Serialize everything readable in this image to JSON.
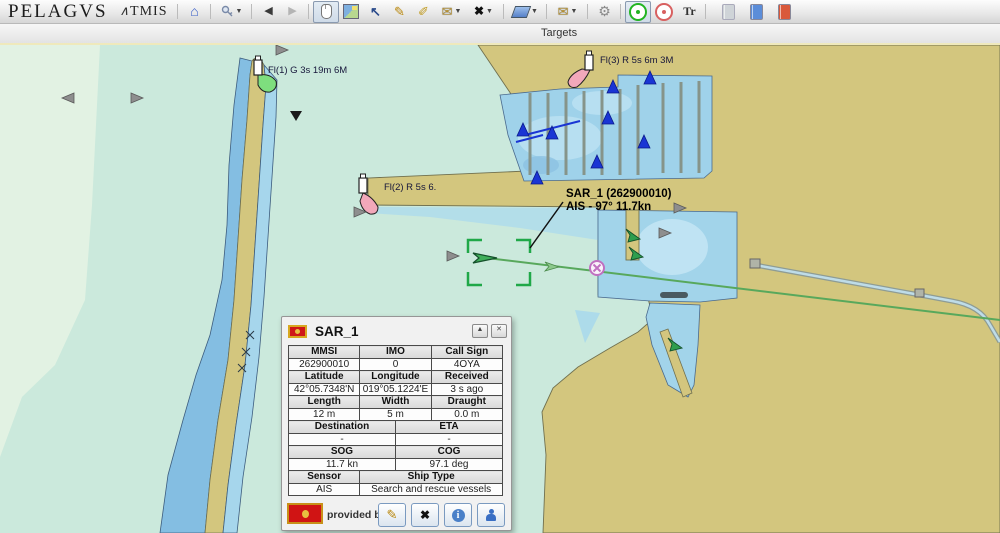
{
  "toolbar": {
    "brand": "PELAGVS",
    "brand_mark": "∧",
    "brand2": "TMIS",
    "glyphs": {
      "home": "⌂",
      "back": "◀",
      "forward": "▶",
      "caret": "▼",
      "cursor_tool": "↖",
      "pencil": "✎",
      "clip": "✐",
      "envelope": "✉",
      "tools": "✖",
      "gear": "⚙",
      "tr": "Tr"
    }
  },
  "tabbar": {
    "label": "Targets"
  },
  "map": {
    "lights": [
      {
        "label": "Fl(1) G 3s 19m 6M"
      },
      {
        "label": "Fl(2) R 5s 6."
      },
      {
        "label": "Fl(3) R 5s 6m 3M"
      }
    ],
    "target_callout": {
      "line1": "SAR_1 (262900010)",
      "line2": "AIS - 97° 11.7kn"
    }
  },
  "popup": {
    "title": "SAR_1",
    "minimize_glyph": "▲",
    "close_glyph": "✕",
    "sections": [
      {
        "headers": [
          "MMSI",
          "IMO",
          "Call Sign"
        ],
        "values": [
          "262900010",
          "0",
          "4OYA"
        ],
        "spans": [
          2,
          2,
          2
        ]
      },
      {
        "headers": [
          "Latitude",
          "Longitude",
          "Received"
        ],
        "values": [
          "42°05.7348'N",
          "019°05.1224'E",
          "3 s ago"
        ],
        "spans": [
          2,
          2,
          2
        ]
      },
      {
        "headers": [
          "Length",
          "Width",
          "Draught"
        ],
        "values": [
          "12 m",
          "5 m",
          "0.0 m"
        ],
        "spans": [
          2,
          2,
          2
        ]
      },
      {
        "headers": [
          "Destination",
          "ETA"
        ],
        "values": [
          "-",
          "-"
        ],
        "spans": [
          3,
          3
        ]
      },
      {
        "headers": [
          "SOG",
          "COG"
        ],
        "values": [
          "11.7 kn",
          "97.1 deg"
        ],
        "spans": [
          3,
          3
        ]
      },
      {
        "headers": [
          "Sensor",
          "Ship Type"
        ],
        "values": [
          "AIS",
          "Search and rescue vessels"
        ],
        "spans": [
          2,
          4
        ]
      }
    ],
    "footer_text": "provided by ELI"
  },
  "colors": {
    "sea_teal": "#cbe9dc",
    "sea_pale": "#e2f2e3",
    "water_blue": "#84bee2",
    "basin_blue": "#a2d4ea",
    "land_tan": "#d3c67e",
    "track_green": "#58a85c",
    "selection_green": "#1fa848",
    "ais_blue": "#1a35d4",
    "event_magenta": "#c070c0"
  }
}
